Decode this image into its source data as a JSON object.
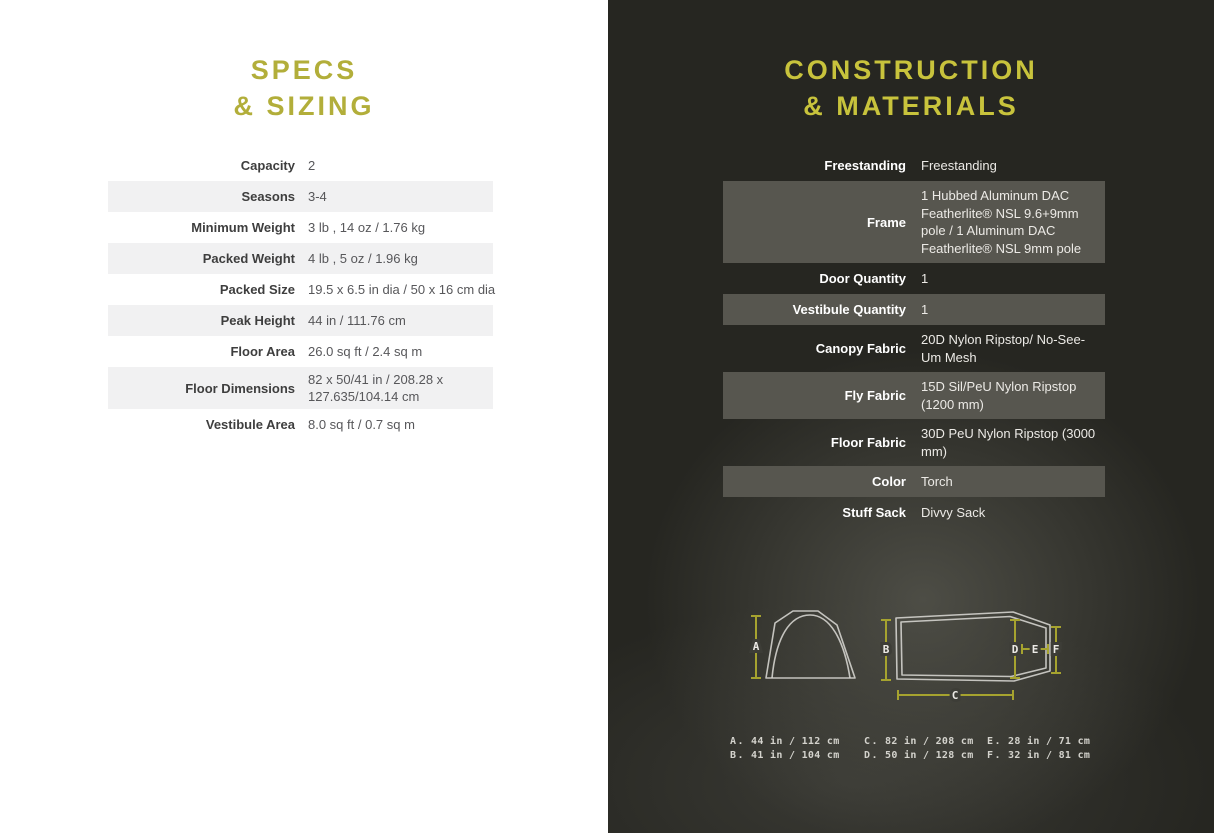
{
  "theme": {
    "left_accent": "#b2ae3a",
    "right_accent": "#c8c33c",
    "dark_bg": "#262621",
    "light_row": "#f1f1f2",
    "dark_row": "#57564f",
    "measure_color": "#a6a32f"
  },
  "specs": {
    "title_line1": "SPECS",
    "title_line2": "& SIZING",
    "rows": [
      {
        "label": "Capacity",
        "value": "2"
      },
      {
        "label": "Seasons",
        "value": "3-4"
      },
      {
        "label": "Minimum Weight",
        "value": "3 lb , 14 oz / 1.76 kg"
      },
      {
        "label": "Packed Weight",
        "value": "4 lb , 5 oz / 1.96 kg"
      },
      {
        "label": "Packed Size",
        "value": "19.5 x 6.5 in dia / 50 x 16 cm dia"
      },
      {
        "label": "Peak Height",
        "value": "44 in / 111.76 cm"
      },
      {
        "label": "Floor Area",
        "value": "26.0 sq ft / 2.4 sq m"
      },
      {
        "label": "Floor Dimensions",
        "value": "82 x 50/41 in / 208.28 x 127.635/104.14 cm"
      },
      {
        "label": "Vestibule Area",
        "value": "8.0 sq ft / 0.7 sq m"
      }
    ]
  },
  "construction": {
    "title_line1": "CONSTRUCTION",
    "title_line2": "& MATERIALS",
    "rows": [
      {
        "label": "Freestanding",
        "value": "Freestanding"
      },
      {
        "label": "Frame",
        "value": "1 Hubbed Aluminum DAC Featherlite® NSL 9.6+9mm pole / 1 Aluminum DAC Featherlite® NSL 9mm pole"
      },
      {
        "label": "Door Quantity",
        "value": "1"
      },
      {
        "label": "Vestibule Quantity",
        "value": "1"
      },
      {
        "label": "Canopy Fabric",
        "value": "20D Nylon Ripstop/ No-See-Um Mesh"
      },
      {
        "label": "Fly Fabric",
        "value": "15D Sil/PeU Nylon Ripstop (1200 mm)"
      },
      {
        "label": "Floor Fabric",
        "value": "30D PeU Nylon Ripstop (3000 mm)"
      },
      {
        "label": "Color",
        "value": "Torch"
      },
      {
        "label": "Stuff Sack",
        "value": "Divvy Sack"
      }
    ]
  },
  "diagram": {
    "markers": {
      "a": "A",
      "b": "B",
      "c": "C",
      "d": "D",
      "e": "E",
      "f": "F"
    },
    "dims": [
      {
        "key": "A.",
        "value": "44 in / 112 cm"
      },
      {
        "key": "B.",
        "value": "41 in / 104 cm"
      },
      {
        "key": "C.",
        "value": "82 in / 208 cm"
      },
      {
        "key": "D.",
        "value": "50 in / 128 cm"
      },
      {
        "key": "E.",
        "value": "28 in / 71 cm"
      },
      {
        "key": "F.",
        "value": "32 in / 81 cm"
      }
    ]
  }
}
